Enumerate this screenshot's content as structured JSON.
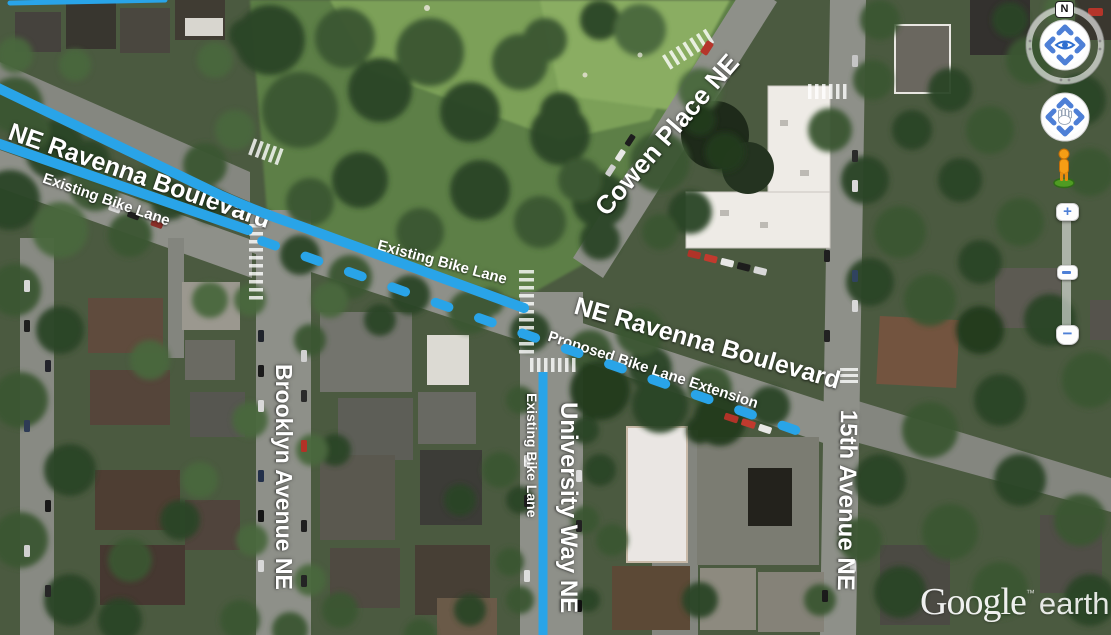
{
  "watermark": {
    "brand": "Google",
    "trademark": "™",
    "product": "earth"
  },
  "navigation": {
    "north_label": "N",
    "zoom_in_label": "+",
    "zoom_out_label": "−"
  },
  "colors": {
    "bike_lane": "#29a4e8",
    "label": "#ffffff"
  },
  "map": {
    "street_labels": {
      "ravenna_west": "NE Ravenna Boulevard",
      "ravenna_east": "NE Ravenna Boulevard",
      "cowen": "Cowen Place NE",
      "brooklyn": "Brooklyn Avenue NE",
      "university": "University Way NE",
      "fifteenth": "15th Avenue NE"
    },
    "bike_lane_labels": {
      "existing_west": "Existing Bike Lane",
      "existing_mid": "Existing Bike Lane",
      "existing_university": "Existing Bike Lane",
      "proposed": "Proposed Bike Lane Extension"
    }
  }
}
